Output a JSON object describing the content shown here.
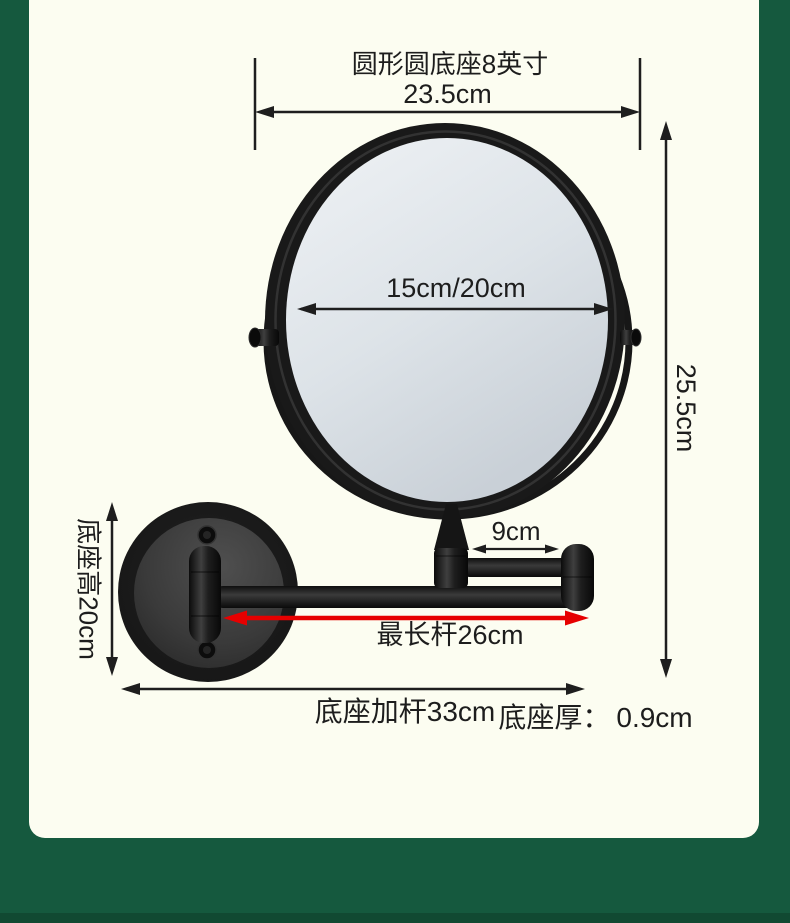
{
  "page": {
    "background_color": "#15593E",
    "panel_color": "#FCFDF1",
    "dimension_line_color": "#1E1E1E",
    "highlight_arrow_color": "#E60000",
    "product_color": "#161616",
    "mirror_glass_color": "#DDE3E8"
  },
  "diagram": {
    "top_label": "圆形圆底座8英寸",
    "top_width": "23.5cm",
    "mirror_diameter": "15cm/20cm",
    "upper_arm_length": "9cm",
    "max_rod_length": "最长杆26cm",
    "base_plus_rod_length": "底座加杆33cm",
    "base_thickness_label": "底座厚：",
    "base_thickness_value": "0.9cm",
    "base_height": "底座高20cm",
    "overall_height": "25.5cm"
  }
}
